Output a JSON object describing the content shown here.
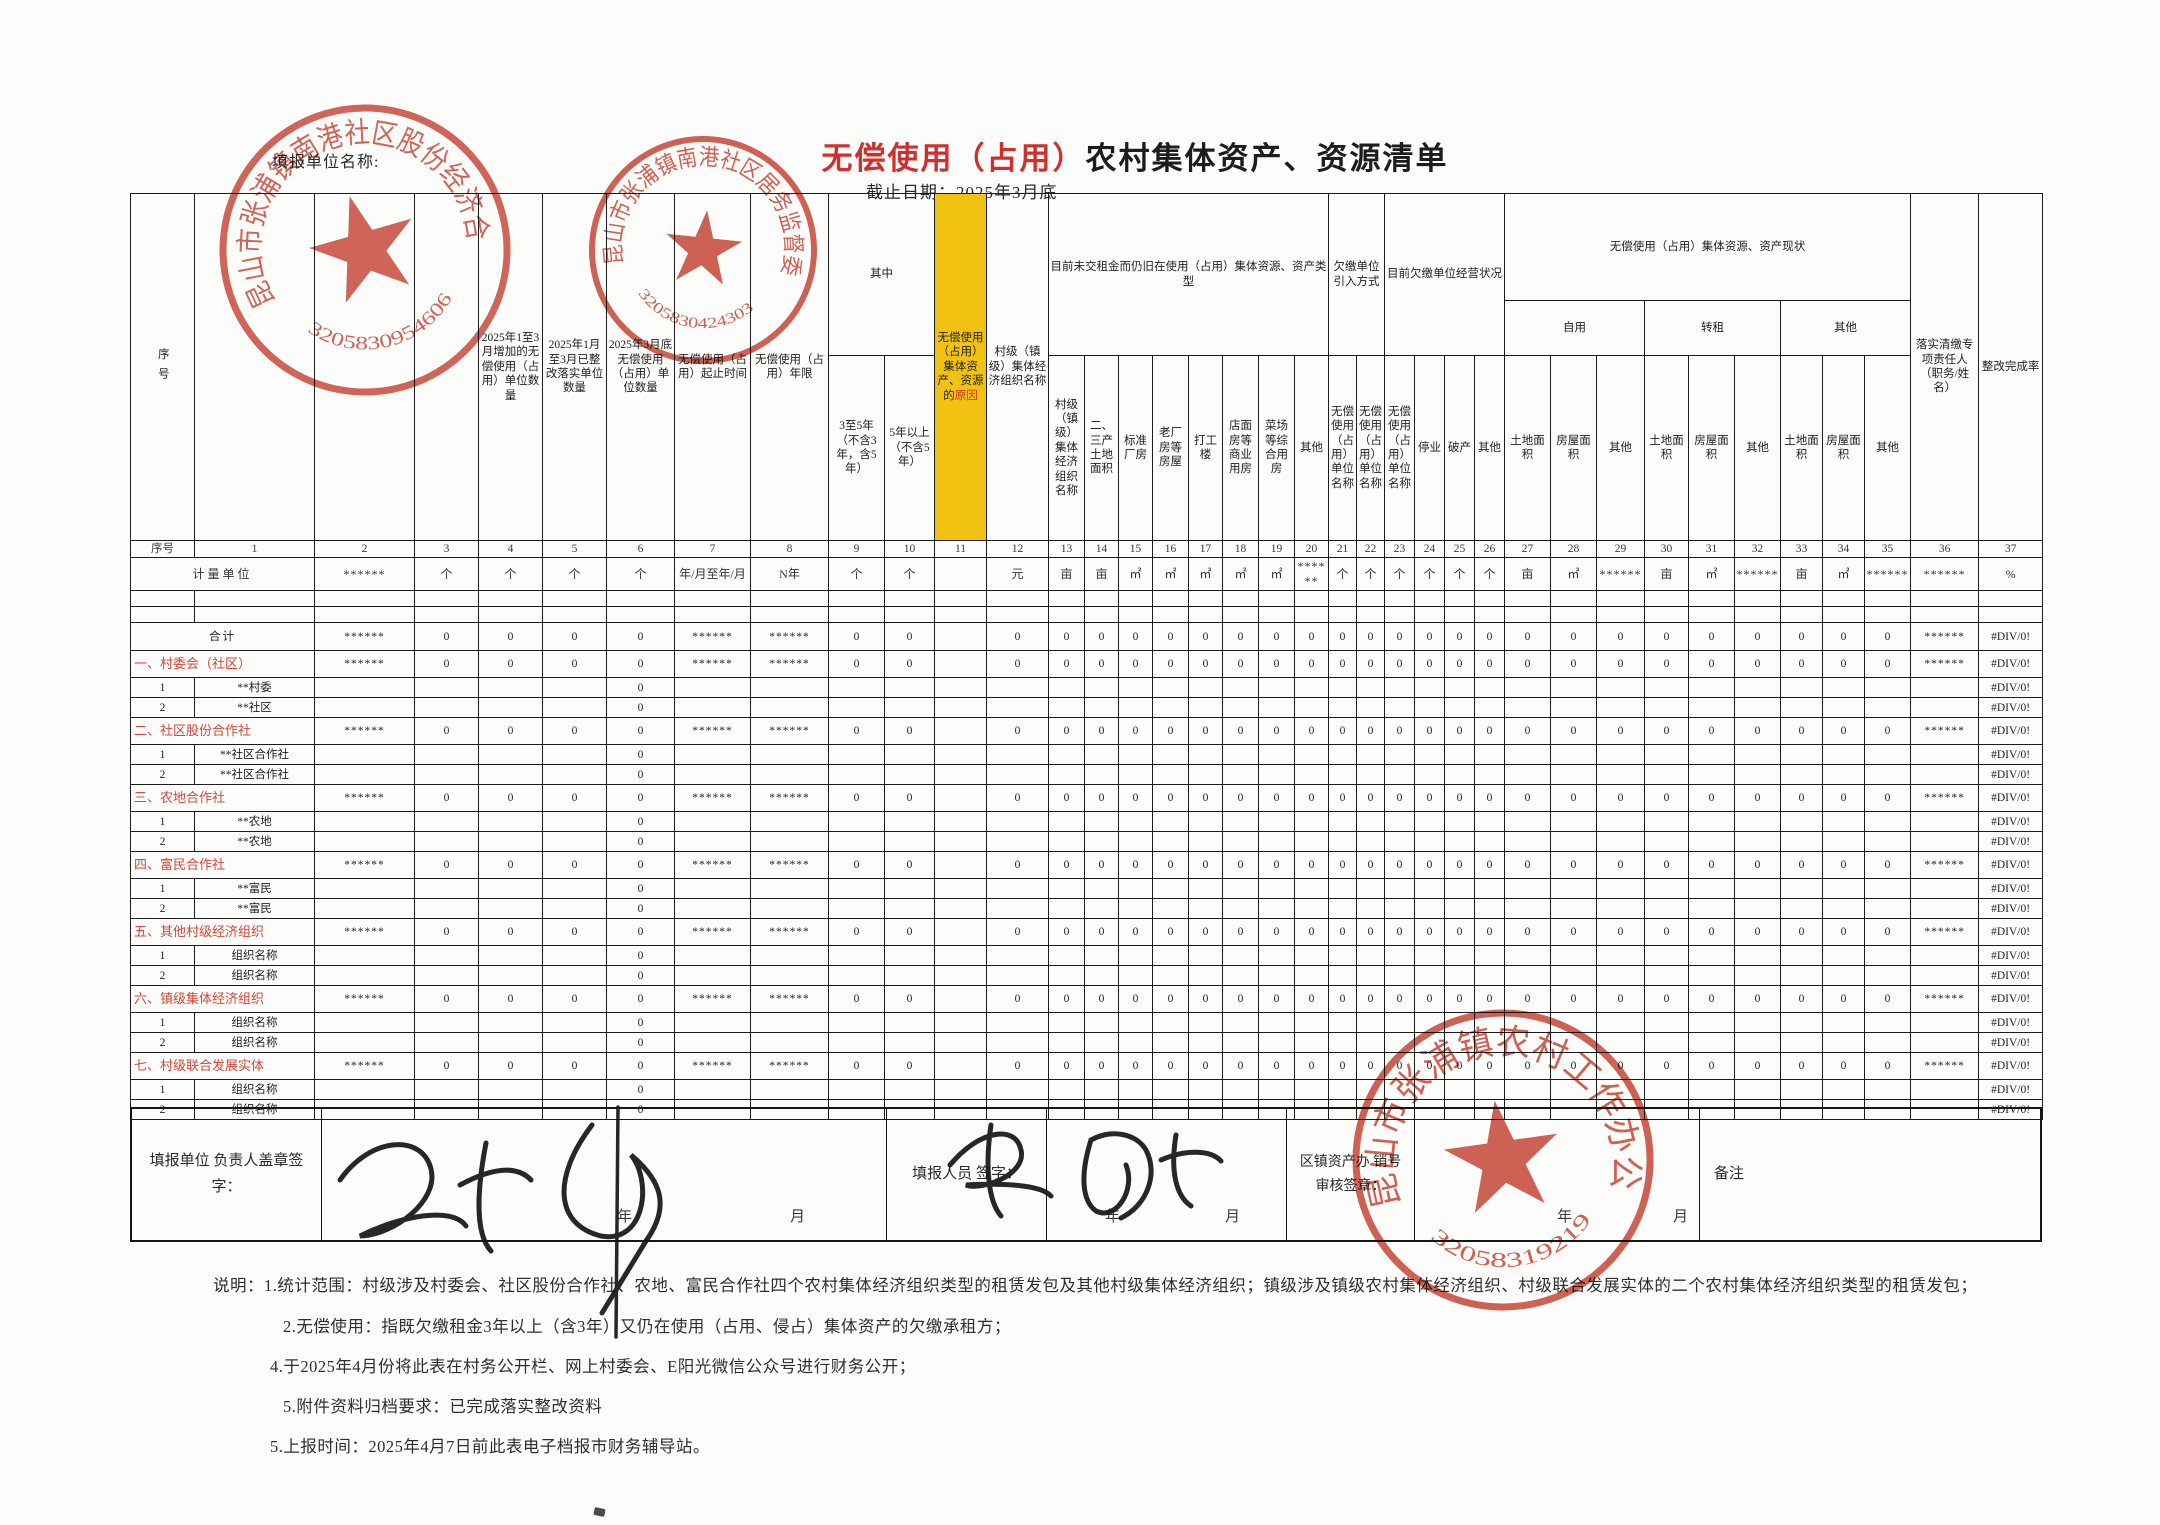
{
  "page": {
    "unit_name_label": "填报单位名称:",
    "title_red": "无偿使用（占用）",
    "title_black": "农村集体资产、资源清单",
    "deadline": "截止日期：2025年3月底"
  },
  "table": {
    "unit_label": "计量单位",
    "index_row": [
      "序号",
      "1",
      "2",
      "3",
      "4",
      "5",
      "6",
      "7",
      "8",
      "9",
      "10",
      "11",
      "12",
      "13",
      "14",
      "15",
      "16",
      "17",
      "18",
      "19",
      "20",
      "21",
      "22",
      "23",
      "24",
      "25",
      "26",
      "27",
      "28",
      "29",
      "30",
      "31",
      "32",
      "33",
      "34",
      "35",
      "36",
      "37"
    ],
    "units": [
      "******",
      "个",
      "个",
      "个",
      "个",
      "年/月至年/月",
      "N年",
      "个",
      "个",
      "",
      "元",
      "亩",
      "亩",
      "㎡",
      "㎡",
      "㎡",
      "㎡",
      "㎡",
      "******",
      "个",
      "个",
      "个",
      "个",
      "个",
      "个",
      "亩",
      "㎡",
      "******",
      "亩",
      "㎡",
      "******",
      "亩",
      "㎡",
      "******",
      "******",
      "%"
    ],
    "columns": {
      "corner": "序号",
      "c1": "村级（镇级）集体经济组织名称",
      "c2": "无偿使用（占用）单位名称",
      "c3": "至2024年12月底无偿使用（占用）单位数量",
      "c4": "2025年1至3月增加的无偿使用（占用）单位数量",
      "c5": "2025年1月至3月已整改落实单位数量",
      "c6": "2025年3月底无偿使用（占用）单位数量",
      "c7": "无偿使用（占用）起止时间",
      "c8": "无偿使用（占用）年限",
      "g_qizhong": "其中",
      "c9": "3至5年（不含3年，含5年）",
      "c10": "5年以上（不含5年）",
      "c11_prefix": "无偿使用（占用）集体资产、资源的",
      "c11_highlight": "原因",
      "c12": "至2025年3月底累计欠缴租金金额",
      "g_types": "目前未交租金而仍旧在使用（占用）集体资源、资产类型",
      "c13": "农业种植养殖",
      "c14": "二、三产土地面积",
      "c15": "标准厂房",
      "c16": "老厂房等房屋",
      "c17": "打工楼",
      "c18": "店面房等商业用房",
      "c19": "菜场等综合用房",
      "c20": "其他",
      "g_intro": "欠缴单位引入方式",
      "c21": "村级招租",
      "c22": "镇级招租",
      "g_status": "目前欠缴单位经营状况",
      "c23": "正常",
      "c24": "停业",
      "c25": "破产",
      "c26": "其他",
      "g_current": "无偿使用（占用）集体资源、资产现状",
      "g_selfuse": "自用",
      "g_sublet": "转租",
      "g_other": "其他",
      "land": "土地面积",
      "house": "房屋面积",
      "other": "其他",
      "c36": "落实清缴专项责任人（职务/姓名）",
      "c37": "整改完成率"
    },
    "values_filled": [
      "******",
      "0",
      "0",
      "0",
      "0",
      "******",
      "******",
      "0",
      "0",
      "",
      "0",
      "0",
      "0",
      "0",
      "0",
      "0",
      "0",
      "0",
      "0",
      "0",
      "0",
      "0",
      "0",
      "0",
      "0",
      "0",
      "0",
      "0",
      "0",
      "0",
      "0",
      "0",
      "0",
      "0",
      "******",
      "#DIV/0!"
    ],
    "values_item": [
      "",
      "",
      "",
      "",
      "0",
      "",
      "",
      "",
      "",
      "",
      "",
      "",
      "",
      "",
      "",
      "",
      "",
      "",
      "",
      "",
      "",
      "",
      "",
      "",
      "",
      "",
      "",
      "",
      "",
      "",
      "",
      "",
      "",
      "",
      "",
      "#DIV/0!"
    ],
    "rows": [
      {
        "kind": "total",
        "label": "合计"
      },
      {
        "kind": "section",
        "label": "一、村委会（社区）"
      },
      {
        "kind": "item",
        "num": "1",
        "label": "**村委"
      },
      {
        "kind": "item",
        "num": "2",
        "label": "**社区"
      },
      {
        "kind": "section",
        "label": "二、社区股份合作社"
      },
      {
        "kind": "item",
        "num": "1",
        "label": "**社区合作社"
      },
      {
        "kind": "item",
        "num": "2",
        "label": "**社区合作社"
      },
      {
        "kind": "section",
        "label": "三、农地合作社"
      },
      {
        "kind": "item",
        "num": "1",
        "label": "**农地"
      },
      {
        "kind": "item",
        "num": "2",
        "label": "**农地"
      },
      {
        "kind": "section",
        "label": "四、富民合作社"
      },
      {
        "kind": "item",
        "num": "1",
        "label": "**富民"
      },
      {
        "kind": "item",
        "num": "2",
        "label": "**富民"
      },
      {
        "kind": "section",
        "label": "五、其他村级经济组织"
      },
      {
        "kind": "item",
        "num": "1",
        "label": "组织名称"
      },
      {
        "kind": "item",
        "num": "2",
        "label": "组织名称"
      },
      {
        "kind": "section",
        "label": "六、镇级集体经济组织"
      },
      {
        "kind": "item",
        "num": "1",
        "label": "组织名称"
      },
      {
        "kind": "item",
        "num": "2",
        "label": "组织名称"
      },
      {
        "kind": "section",
        "label": "七、村级联合发展实体"
      },
      {
        "kind": "item",
        "num": "1",
        "label": "组织名称"
      },
      {
        "kind": "item",
        "num": "2",
        "label": "组织名称"
      }
    ]
  },
  "footer": {
    "label_unit_head": "填报单位 负责人盖章签字：",
    "label_filler": "填报人员 签字：",
    "label_review": "区镇资产办 销号审核签章：",
    "year": "年",
    "month": "月",
    "remark_label": "备注"
  },
  "notes": [
    "说明：1.统计范围：村级涉及村委会、社区股份合作社、农地、富民合作社四个农村集体经济组织类型的租赁发包及其他村级集体经济组织；镇级涉及镇级农村集体经济组织、村级联合发展实体的二个农村集体经济组织类型的租赁发包；",
    "2.无偿使用：指既欠缴租金3年以上（含3年）又仍在使用（占用、侵占）集体资产的欠缴承租方；",
    "4.于2025年4月份将此表在村务公开栏、网上村委会、E阳光微信公众号进行财务公开；",
    "5.附件资料归档要求：已完成落实整改资料",
    "5.上报时间：2025年4月7日前此表电子档报市财务辅导站。"
  ],
  "stamps": [
    {
      "text": "昆山市张浦镇南港社区股份经济合作社",
      "number": "3205830954606"
    },
    {
      "text": "昆山市张浦镇南港社区居务监督委员会",
      "number": "3205830424303"
    },
    {
      "text": "昆山市张浦镇农村工作办公室",
      "number": "32058319219"
    }
  ],
  "colors": {
    "accent_red": "#cf2f2f",
    "highlight_yellow": "#f2c212",
    "stamp_red": "#c53a2b",
    "value_orange": "#c05a40",
    "error_red": "#cf4730"
  }
}
